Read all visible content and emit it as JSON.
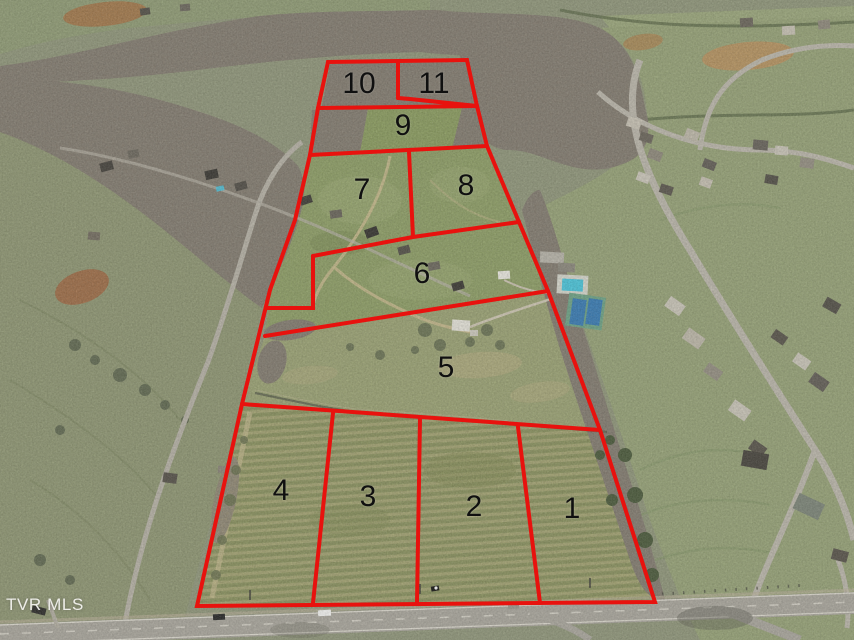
{
  "watermark": {
    "label": "TVR MLS"
  },
  "lot_overlay": {
    "boundary_color": "#e8120e",
    "lots": [
      {
        "number": "1"
      },
      {
        "number": "2"
      },
      {
        "number": "3"
      },
      {
        "number": "4"
      },
      {
        "number": "5"
      },
      {
        "number": "6"
      },
      {
        "number": "7"
      },
      {
        "number": "8"
      },
      {
        "number": "9"
      },
      {
        "number": "10"
      },
      {
        "number": "11"
      }
    ]
  },
  "palette": {
    "boundary_red": "#e8120e",
    "field_green": "#8d9c68",
    "pasture_green": "#8e9574",
    "tree_brown": "#837b6e",
    "road_gray": "#a7a49b",
    "pool_blue": "#4fc0d4",
    "tennis_blue": "#3e7cb0",
    "number_black": "#101010",
    "watermark_white": "#f0efec"
  }
}
